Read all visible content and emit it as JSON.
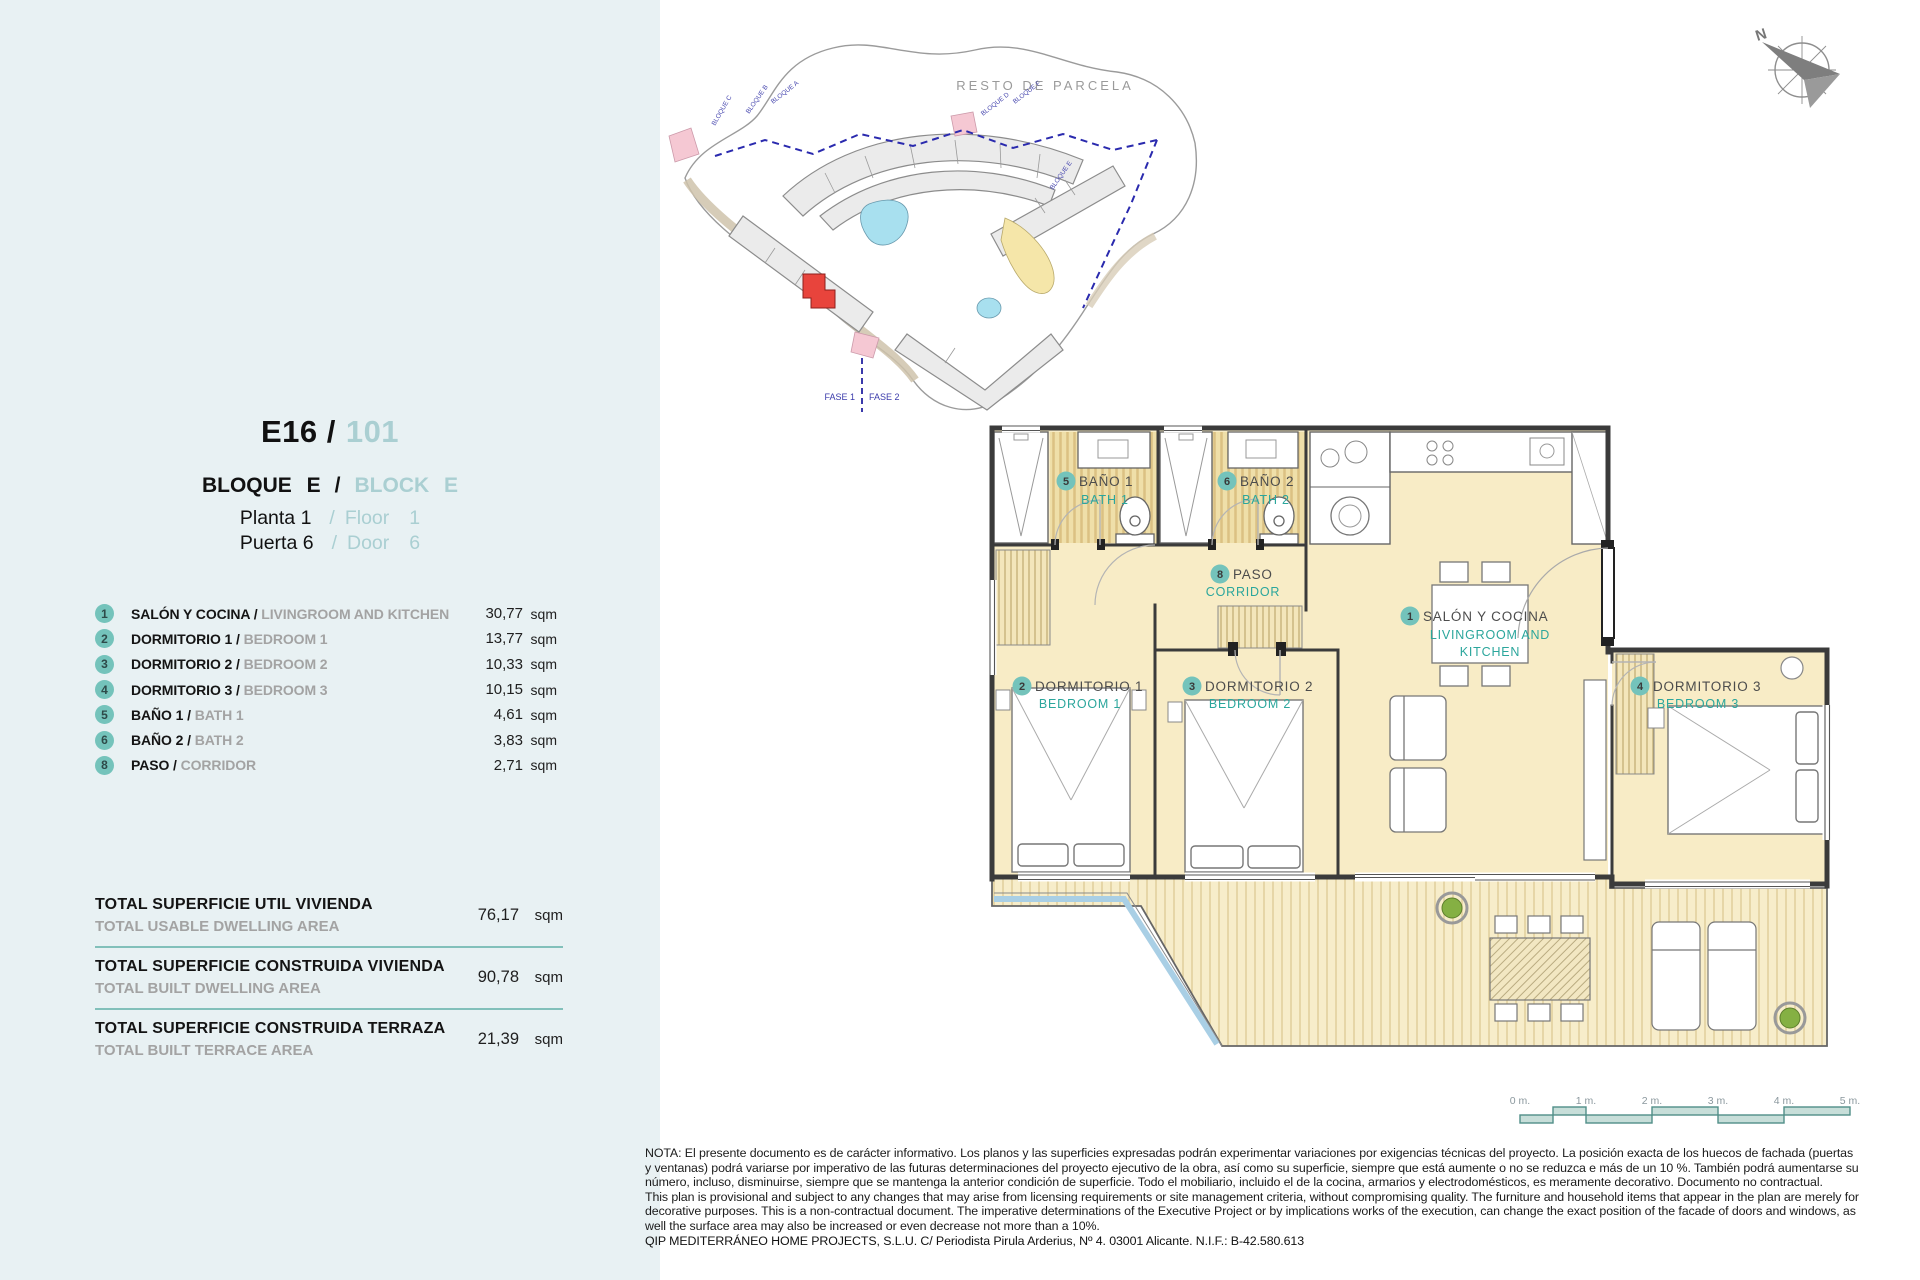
{
  "header": {
    "unit_code": "E16 /",
    "unit_number": "101",
    "block_es": "BLOQUE E",
    "slash": "/",
    "block_en": "BLOCK E",
    "floor_es": "Planta 1",
    "floor_en_word": "Floor",
    "floor_en_num": "1",
    "door_es": "Puerta 6",
    "door_en_word": "Door",
    "door_en_num": "6"
  },
  "rooms": [
    {
      "num": "1",
      "es": "SALÓN Y COCINA /",
      "en": "LIVINGROOM AND KITCHEN",
      "val": "30,77",
      "unit": "sqm"
    },
    {
      "num": "2",
      "es": "DORMITORIO 1 /",
      "en": "BEDROOM 1",
      "val": "13,77",
      "unit": "sqm"
    },
    {
      "num": "3",
      "es": "DORMITORIO 2 /",
      "en": "BEDROOM 2",
      "val": "10,33",
      "unit": "sqm"
    },
    {
      "num": "4",
      "es": "DORMITORIO 3 /",
      "en": "BEDROOM 3",
      "val": "10,15",
      "unit": "sqm"
    },
    {
      "num": "5",
      "es": "BAÑO 1 /",
      "en": "BATH 1",
      "val": "4,61",
      "unit": "sqm"
    },
    {
      "num": "6",
      "es": "BAÑO 2 /",
      "en": "BATH 2",
      "val": "3,83",
      "unit": "sqm"
    },
    {
      "num": "8",
      "es": "PASO /",
      "en": "CORRIDOR",
      "val": "2,71",
      "unit": "sqm"
    }
  ],
  "totals": [
    {
      "es": "TOTAL SUPERFICIE UTIL VIVIENDA",
      "en": "TOTAL USABLE DWELLING AREA",
      "val": "76,17",
      "unit": "sqm"
    },
    {
      "es": "TOTAL SUPERFICIE CONSTRUIDA VIVIENDA",
      "en": "TOTAL BUILT DWELLING AREA",
      "val": "90,78",
      "unit": "sqm"
    },
    {
      "es": "TOTAL SUPERFICIE CONSTRUIDA TERRAZA",
      "en": "TOTAL BUILT TERRACE AREA",
      "val": "21,39",
      "unit": "sqm"
    }
  ],
  "plan": {
    "bath1": {
      "num": "5",
      "es": "BAÑO 1",
      "en": "BATH 1"
    },
    "bath2": {
      "num": "6",
      "es": "BAÑO 2",
      "en": "BATH 2"
    },
    "corridor": {
      "num": "8",
      "es": "PASO",
      "en": "CORRIDOR"
    },
    "living": {
      "num": "1",
      "es": "SALÓN Y COCINA",
      "en1": "LIVINGROOM AND",
      "en2": "KITCHEN"
    },
    "bed1": {
      "num": "2",
      "es": "DORMITORIO 1",
      "en": "BEDROOM 1"
    },
    "bed2": {
      "num": "3",
      "es": "DORMITORIO 2",
      "en": "BEDROOM 2"
    },
    "bed3": {
      "num": "4",
      "es": "DORMITORIO 3",
      "en": "BEDROOM 3"
    }
  },
  "site": {
    "resto": "RESTO DE PARCELA",
    "fase1": "FASE 1",
    "fase2": "FASE 2",
    "north": "N",
    "blocks": [
      "BLOQUE A",
      "BLOQUE B",
      "BLOQUE C",
      "BLOQUE D",
      "BLOQUE F",
      "BLOQUE E"
    ]
  },
  "scalebar": {
    "labels": [
      "0 m.",
      "1 m.",
      "2 m.",
      "3 m.",
      "4 m.",
      "5 m."
    ]
  },
  "notes": {
    "es": "NOTA: El presente documento es de carácter informativo. Los planos y las superficies expresadas podrán experimentar variaciones por exigencias técnicas del proyecto. La posición exacta de los huecos de fachada (puertas y ventanas) podrá variarse por imperativo de las futuras determinaciones del proyecto ejecutivo de la obra, así como su superficie, siempre que está aumente o no se reduzca e más de un 10 %. También podrá aumentarse su número, incluso, disminuirse, siempre que se mantenga la anterior condición de superficie. Todo el mobiliario, incluido el de la cocina, armarios y electrodomésticos, es meramente decorativo. Documento no contractual.",
    "en": "This plan is provisional and subject to any changes that may arise from licensing requirements or site management criteria, without compromising quality. The furniture and household items that appear in the plan are merely for decorative purposes. This is a non-contractual document. The imperative determinations of the Executive Project or by implications works of the execution, can change the exact position of the facade of doors and windows, as well the surface area may also be increased or even decrease not more than a 10%.",
    "footer": "QIP MEDITERRÁNEO HOME PROJECTS, S.L.U. C/ Periodista Pirula Arderius, Nº 4. 03001 Alicante. N.I.F.: B-42.580.613"
  }
}
